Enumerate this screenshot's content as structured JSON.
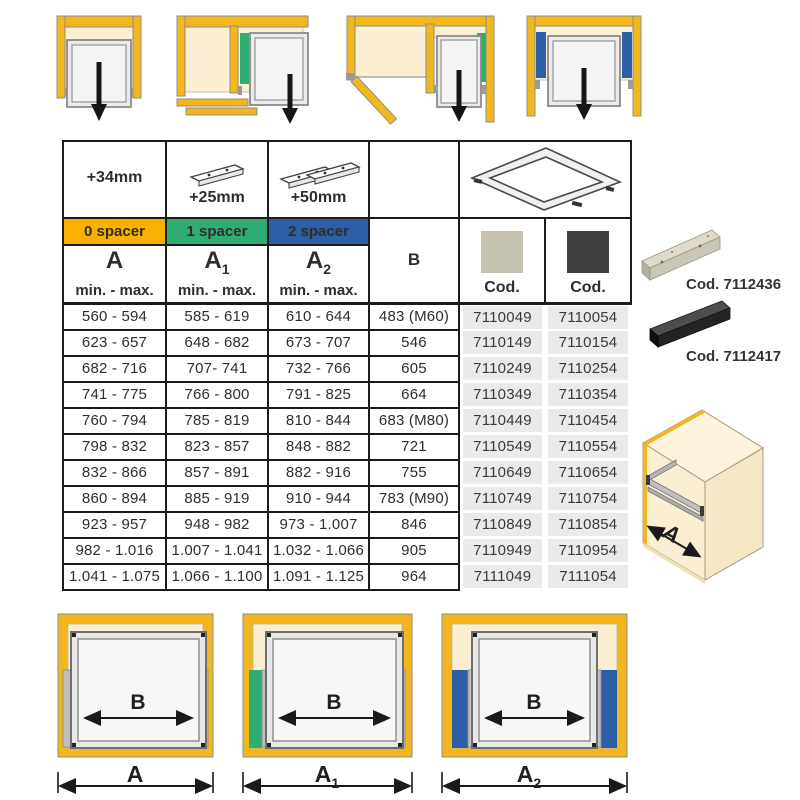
{
  "colors": {
    "spacer0_orange": "#F8B100",
    "spacer1_green": "#2EAC72",
    "spacer2_blue": "#2D5FA8",
    "cabinet_yellow": "#F2B61E",
    "interior_cream": "#FAEFD3",
    "cod_cell_gray": "#EAEAE8",
    "swatch_light": "#C7C3B2",
    "swatch_dark": "#3E3F3F"
  },
  "table": {
    "offset_labels": [
      "+34mm",
      "+25mm",
      "+50mm"
    ],
    "spacer_labels": [
      "0 spacer",
      "1 spacer",
      "2 spacer"
    ],
    "dim_labels": [
      {
        "base": "A",
        "sub": ""
      },
      {
        "base": "A",
        "sub": "1"
      },
      {
        "base": "A",
        "sub": "2"
      }
    ],
    "range_label": "min. - max.",
    "b_label": "B",
    "cod_label_1": "Cod.",
    "cod_label_2": "Cod.",
    "rows": [
      {
        "a": "560 - 594",
        "a1": "585 - 619",
        "a2": "610 - 644",
        "b": "483 (M60)",
        "cod1": "7110049",
        "cod2": "7110054"
      },
      {
        "a": "623 - 657",
        "a1": "648 - 682",
        "a2": "673 - 707",
        "b": "546",
        "cod1": "7110149",
        "cod2": "7110154"
      },
      {
        "a": "682 - 716",
        "a1": "707- 741",
        "a2": "732 - 766",
        "b": "605",
        "cod1": "7110249",
        "cod2": "7110254"
      },
      {
        "a": "741 - 775",
        "a1": "766 - 800",
        "a2": "791 - 825",
        "b": "664",
        "cod1": "7110349",
        "cod2": "7110354"
      },
      {
        "a": "760 - 794",
        "a1": "785 - 819",
        "a2": "810 - 844",
        "b": "683 (M80)",
        "cod1": "7110449",
        "cod2": "7110454"
      },
      {
        "a": "798 - 832",
        "a1": "823 - 857",
        "a2": "848 - 882",
        "b": "721",
        "cod1": "7110549",
        "cod2": "7110554"
      },
      {
        "a": "832 - 866",
        "a1": "857 - 891",
        "a2": "882 - 916",
        "b": "755",
        "cod1": "7110649",
        "cod2": "7110654"
      },
      {
        "a": "860 - 894",
        "a1": "885 - 919",
        "a2": "910 - 944",
        "b": "783 (M90)",
        "cod1": "7110749",
        "cod2": "7110754"
      },
      {
        "a": "923 - 957",
        "a1": "948 - 982",
        "a2": "973 - 1.007",
        "b": "846",
        "cod1": "7110849",
        "cod2": "7110854"
      },
      {
        "a": "982 - 1.016",
        "a1": "1.007 - 1.041",
        "a2": "1.032 - 1.066",
        "b": "905",
        "cod1": "7110949",
        "cod2": "7110954"
      },
      {
        "a": "1.041 - 1.075",
        "a1": "1.066 - 1.100",
        "a2": "1.091 - 1.125",
        "b": "964",
        "cod1": "7111049",
        "cod2": "7111054"
      }
    ]
  },
  "products": [
    {
      "label": "Cod. 7112436"
    },
    {
      "label": "Cod. 7112417"
    }
  ],
  "bottom_diagrams": [
    {
      "inner": "B",
      "outer": "A",
      "sub": ""
    },
    {
      "inner": "B",
      "outer": "A",
      "sub": "1"
    },
    {
      "inner": "B",
      "outer": "A",
      "sub": "2"
    }
  ],
  "cabinet_3d": {
    "label": "A"
  }
}
